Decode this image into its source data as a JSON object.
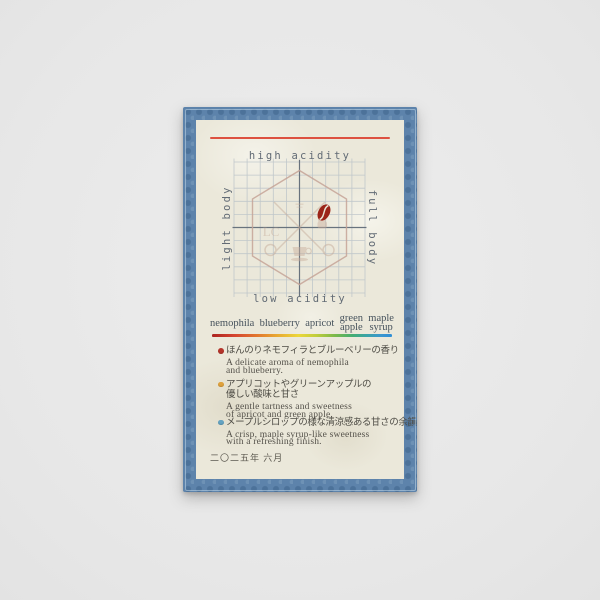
{
  "card": {
    "chart": {
      "label_top": "high acidity",
      "label_bottom": "low acidity",
      "label_left": "light body",
      "label_right": "full body",
      "emblem_initials": "LC",
      "marker": "coffee-bean"
    },
    "flavor_bar": {
      "items": [
        {
          "lines": [
            "nemophila"
          ]
        },
        {
          "lines": [
            "blueberry"
          ]
        },
        {
          "lines": [
            "apricot"
          ]
        },
        {
          "lines": [
            "green",
            "apple"
          ]
        },
        {
          "lines": [
            "maple",
            "syrup"
          ]
        }
      ],
      "gradient": [
        "#ab2420",
        "#d44330",
        "#e2772f",
        "#e8a832",
        "#ecd73b",
        "#c0cd3c",
        "#7cb94a",
        "#43ad72",
        "#3aa3a8",
        "#3b97cf",
        "#2f8ed6"
      ]
    },
    "notes": [
      {
        "dot_color": "#b5342a",
        "jp": [
          "ほんのりネモフィラとブルーベリーの香り"
        ],
        "en": [
          "A delicate aroma of nemophila",
          "and blueberry."
        ]
      },
      {
        "dot_color": "#dfa13c",
        "jp": [
          "アプリコットやグリーンアップルの",
          "優しい酸味と甘さ"
        ],
        "en": [
          "A gentle tartness and sweetness",
          "of apricot and green apple."
        ]
      },
      {
        "dot_color": "#64a3c2",
        "jp": [
          "メープルシロップの様な清涼感ある甘さの余韻"
        ],
        "en": [
          "A crisp, maple syrup-like sweetness",
          "with a refreshing finish."
        ]
      }
    ],
    "date": "二〇二五年 六月",
    "colors": {
      "border_blue": "#5d83ab",
      "card_cream": "#ebe8da",
      "rule_red": "#dd5140",
      "bean_red": "#9c2418",
      "grid": "#bcc4c9",
      "axis": "#5d6874",
      "hexagon": "#c6a396"
    }
  },
  "chart_data": {
    "type": "scatter",
    "title": "coffee flavor position chart",
    "x_axis": {
      "label_left": "light body",
      "label_right": "full body",
      "range": [
        -1,
        1
      ]
    },
    "y_axis": {
      "label_bottom": "low acidity",
      "label_top": "high acidity",
      "range": [
        -1,
        1
      ]
    },
    "grid": "on",
    "points": [
      {
        "marker": "coffee-bean",
        "body": 0.37,
        "acidity": 0.23
      }
    ]
  }
}
